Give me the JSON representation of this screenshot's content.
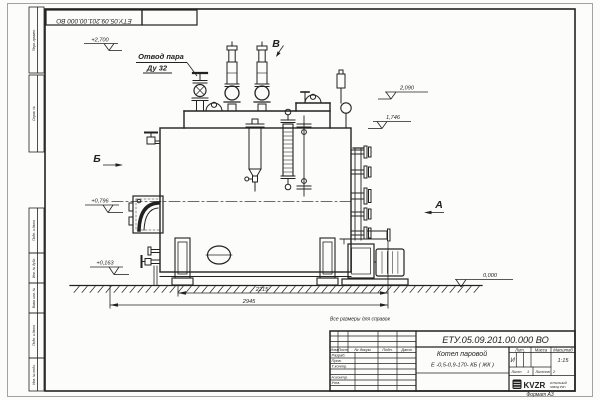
{
  "frame": {
    "top_stamp": "ЕТУ.05.09.201.00.000 ВО",
    "format_note": "Формат А3",
    "margin_labels": {
      "perv_primen": "Перв. примен.",
      "sprav_no": "Справ. №",
      "podp_data_1": "Подп. и дата",
      "inv_dubl": "Инв. № дубл.",
      "vzam_inv": "Взам. инв. №",
      "podp_data_2": "Подп. и дата",
      "inv_podl": "Инв. № подл."
    }
  },
  "annotations": {
    "note": "Все размеры для справок",
    "steam_outlet_line1": "Отвод пара",
    "steam_outlet_line2": "Ду 32",
    "view_top": "В",
    "view_left": "Б",
    "view_right": "А",
    "elev_top": "+2,700",
    "elev_drum": "2,090",
    "elev_shell": "1,746",
    "elev_burner": "+0,796",
    "elev_drain": "+0,163",
    "elev_ground": "0,000",
    "dim_body": "2215",
    "dim_overall": "2945"
  },
  "title_block": {
    "designation": "ЕТУ.05.09.201.00.000 ВО",
    "product_line1": "Котел паровой",
    "product_line2": "Е -0,5-0,9-170- КБ ( ЖК )",
    "columns": {
      "izm": "Изм",
      "list": "Лист",
      "doc": "№ докум.",
      "podp": "Подп.",
      "data": "Дата"
    },
    "rows": {
      "razrab": "Разраб.",
      "prov": "Пров.",
      "tkontr": "Т.контр.",
      "nkontr": "Н.контр.",
      "utv": "Утв."
    },
    "lit_header": "Лит.",
    "mass_header": "Масса",
    "scale_header": "Масштаб",
    "lit_value": "И",
    "scale_value": "1:15",
    "sheet_label": "Лист",
    "sheet_value": "1",
    "sheets_label": "Листов",
    "sheets_value": "2",
    "company_abbr": "KVZR",
    "company_line1": "КОТЕЛЬНЫЙ",
    "company_line2": "ЗАВОД РЭП"
  }
}
